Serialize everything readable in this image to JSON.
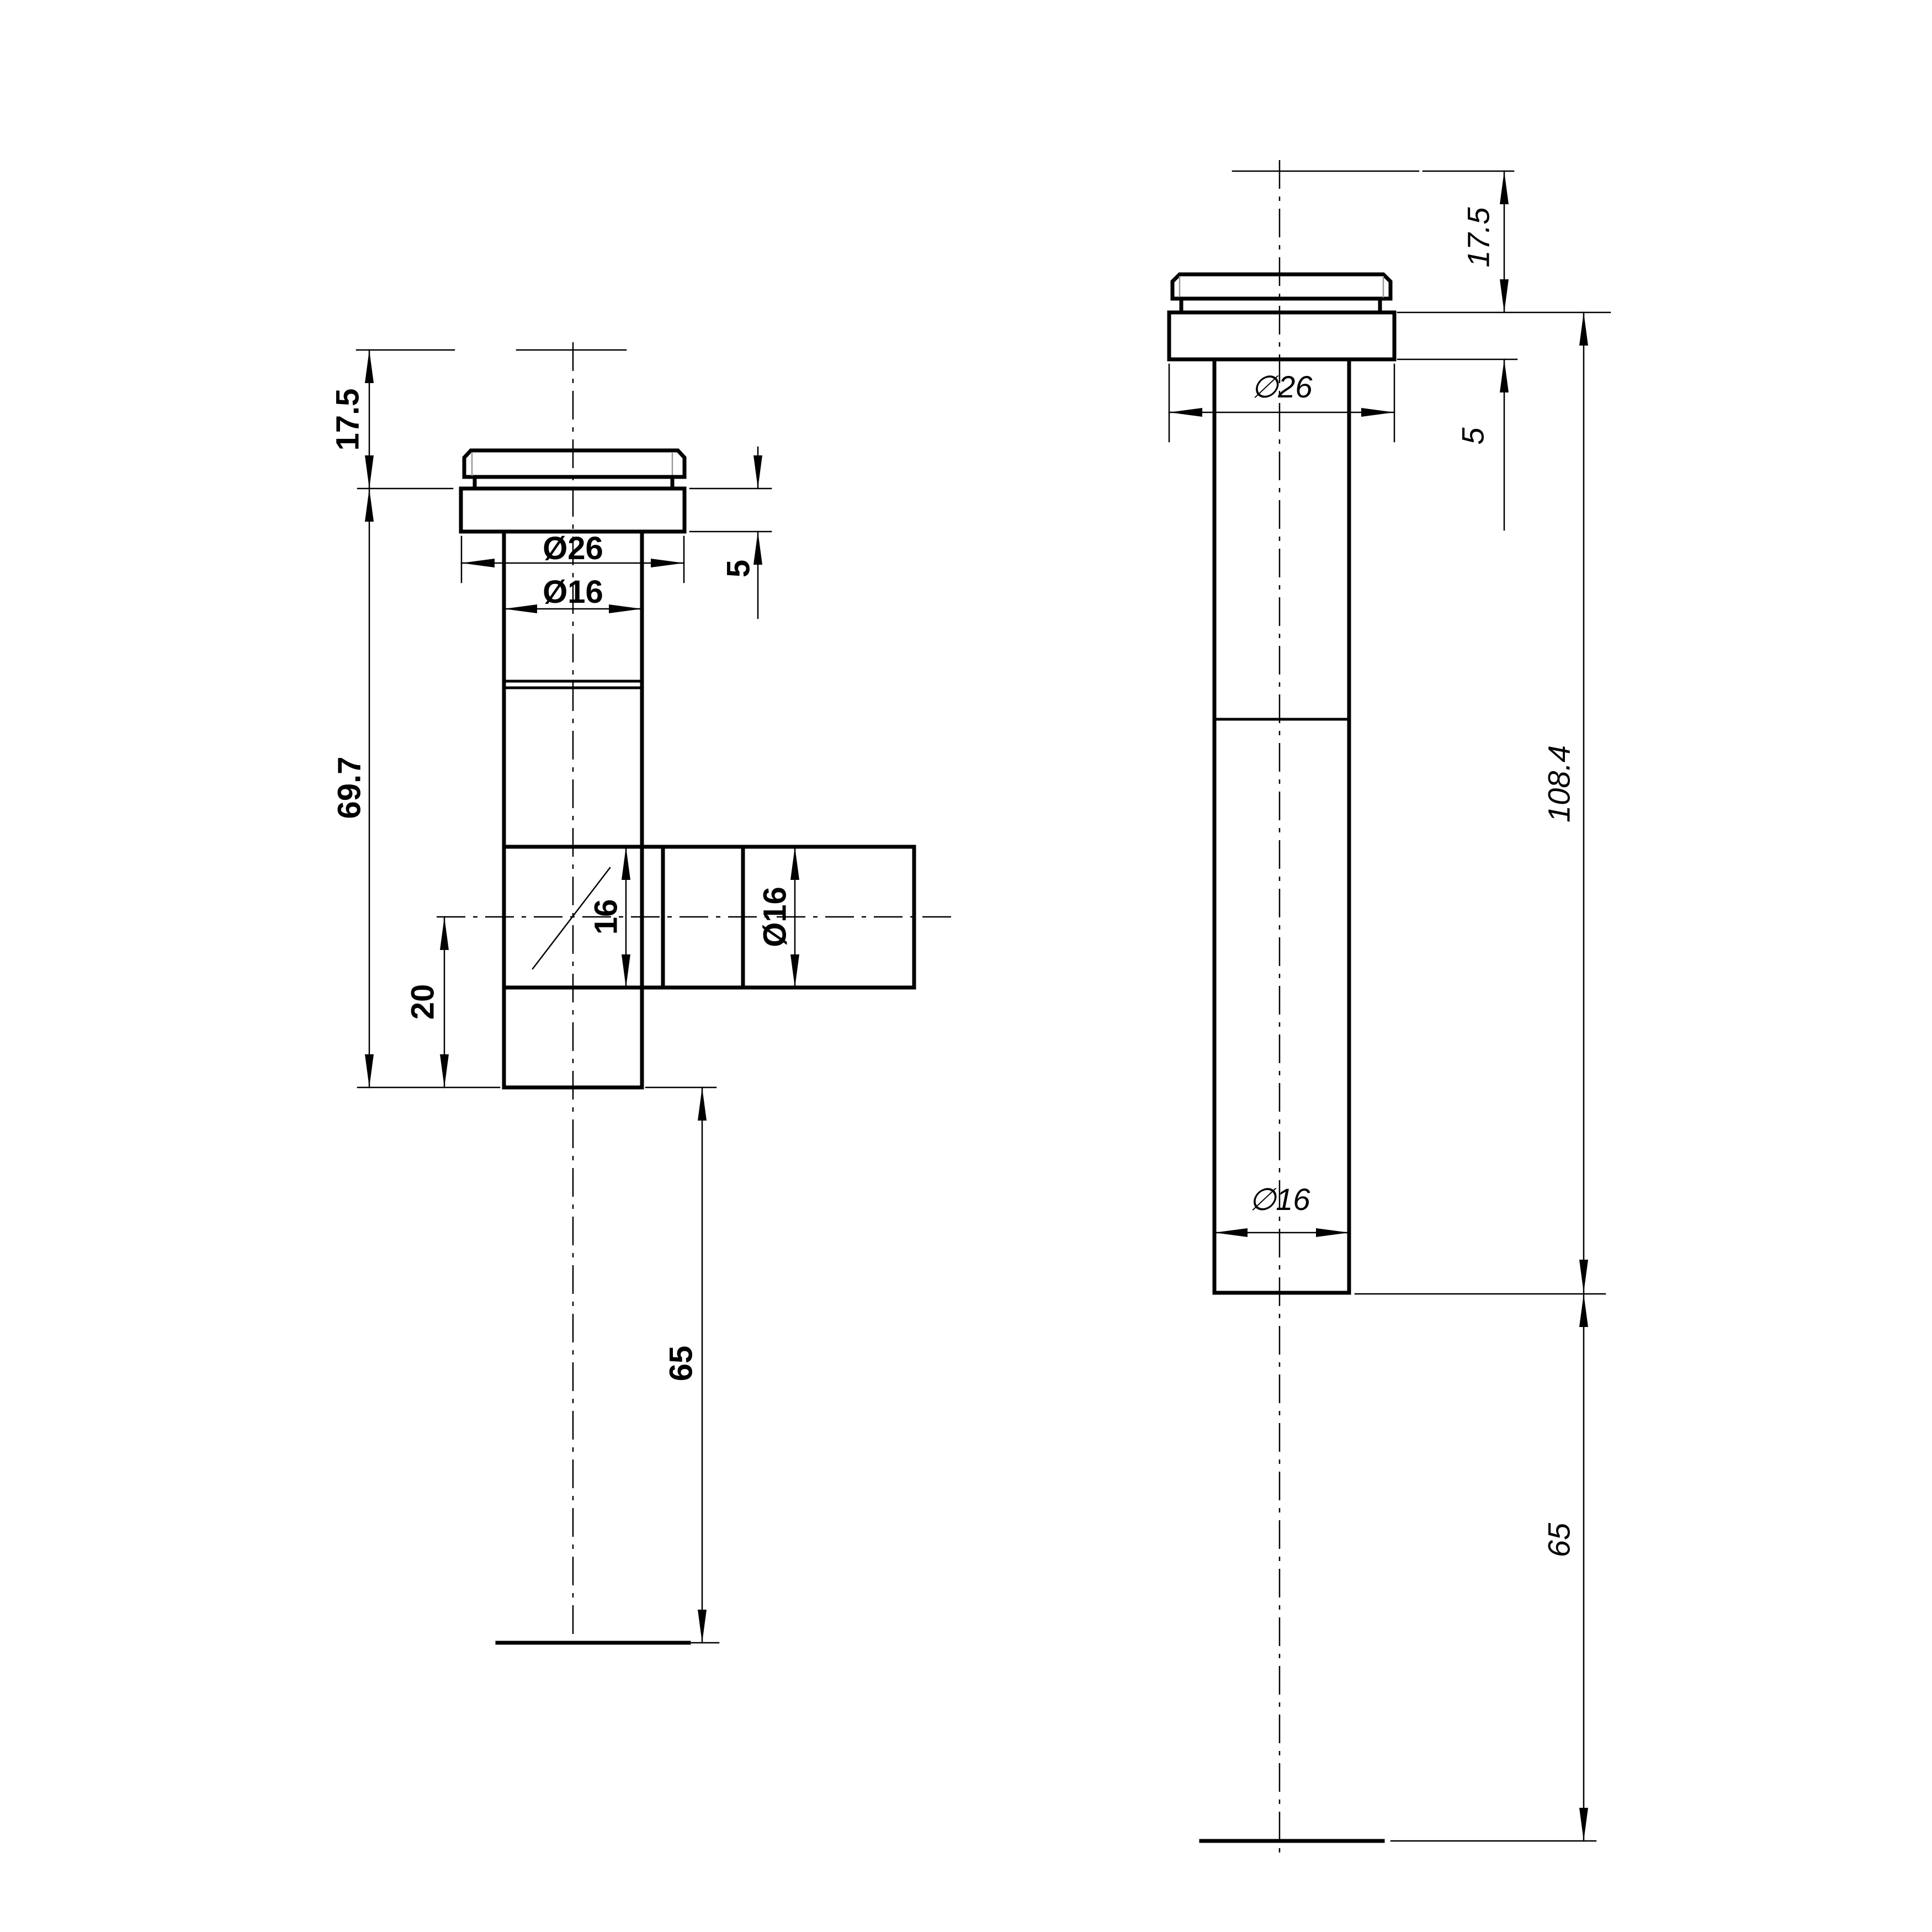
{
  "drawing": {
    "background_color": "#ffffff",
    "line_color": "#000000",
    "chamfer_line_color": "#999999",
    "views": {
      "left_view": {
        "name": "side-view-tee-fitting",
        "labels": {
          "height_cap": "17.5",
          "height_body": "69.7",
          "outer_diameter_flange": "Ø26",
          "outer_diameter_tube": "Ø16",
          "flange_thickness": "5",
          "branch_bore": "16",
          "branch_outer_diameter": "Ø16",
          "branch_offset": "20",
          "tail_length": "65"
        }
      },
      "right_view": {
        "name": "front-view-straight-fitting",
        "labels": {
          "height_cap": "17.5",
          "flange_thickness": "5",
          "outer_diameter_flange": "∅26",
          "body_length": "108.4",
          "outer_diameter_tube": "∅16",
          "tail_length": "65"
        }
      }
    }
  }
}
